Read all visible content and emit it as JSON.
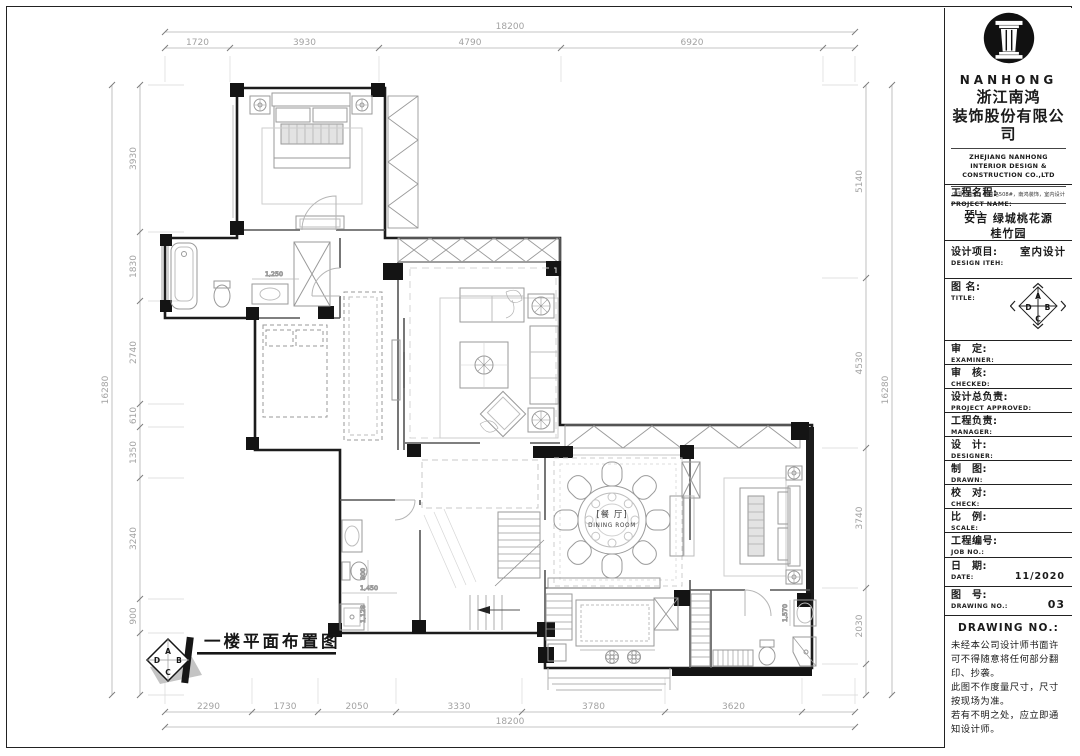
{
  "title_block": {
    "brand": "NANHONG",
    "company_cn": [
      "浙江南鸿",
      "装饰股份有限公司"
    ],
    "company_en": [
      "ZHEJIANG NANHONG",
      "INTERIOR DESIGN &",
      "CONSTRUCTION CO.,LTD"
    ],
    "address": "中国，杭州，绍兴路508#，南鸿装饰，室内设计",
    "tel_label": "TEL:",
    "project": {
      "cn": "工程名程:",
      "en": "PROJECT NAME:",
      "value1": "安吉 绿城桃花源",
      "value2": "桂竹园"
    },
    "design_item": {
      "cn": "设计项目:",
      "en": "DESIGN ITEH:",
      "value": "室内设计"
    },
    "title_field": {
      "cn": "图 名:",
      "en": "TITLE:"
    },
    "rows": [
      {
        "cn": "审　定:",
        "en": "EXAMINER:"
      },
      {
        "cn": "审　核:",
        "en": "CHECKED:"
      },
      {
        "cn": "设计总负责:",
        "en": "PROJECT APPROVED:"
      },
      {
        "cn": "工程负责:",
        "en": "MANAGER:"
      },
      {
        "cn": "设　计:",
        "en": "DESIGNER:"
      },
      {
        "cn": "制　图:",
        "en": "DRAWN:"
      },
      {
        "cn": "校　对:",
        "en": "CHECK:"
      },
      {
        "cn": "比　例:",
        "en": "SCALE:"
      }
    ],
    "job_no": {
      "cn": "工程编号:",
      "en": "JOB  NO.:"
    },
    "date": {
      "cn": "日　期:",
      "en": "DATE:",
      "value": "11/2020"
    },
    "dwg_no": {
      "cn": "图　号:",
      "en": "DRAWING NO.:",
      "value": "03"
    },
    "notes_header": "DRAWING NO.:",
    "notes": [
      "未经本公司设计师书面许可不得随意将任何部分翻印、抄袭。",
      "此图不作度量尺寸，尺寸按现场为准。",
      "若有不明之处，应立即通知设计师。"
    ]
  },
  "compass": {
    "a": "A",
    "b": "B",
    "c": "C",
    "d": "D"
  },
  "plan": {
    "title": "一楼平面布置图",
    "room_labels": [
      {
        "cn": "[餐 厅]",
        "en": "DINING ROOM"
      }
    ],
    "detail_dims": [
      "1,250",
      "1,450",
      "800",
      "1,128",
      "1,570"
    ],
    "dimensions": {
      "top": {
        "overall": "18200",
        "segments": [
          "1720",
          "3930",
          "4790",
          "6920"
        ]
      },
      "bottom": {
        "overall": "18200",
        "segments": [
          "2290",
          "1730",
          "2050",
          "3330",
          "3780",
          "3620"
        ]
      },
      "left": {
        "overall": "16280",
        "segments": [
          "3930",
          "1830",
          "2740",
          "610",
          "1350",
          "3240",
          "900"
        ]
      },
      "right": {
        "overall": "16280",
        "segments": [
          "5140",
          "4530",
          "3740",
          "2030"
        ]
      }
    }
  }
}
